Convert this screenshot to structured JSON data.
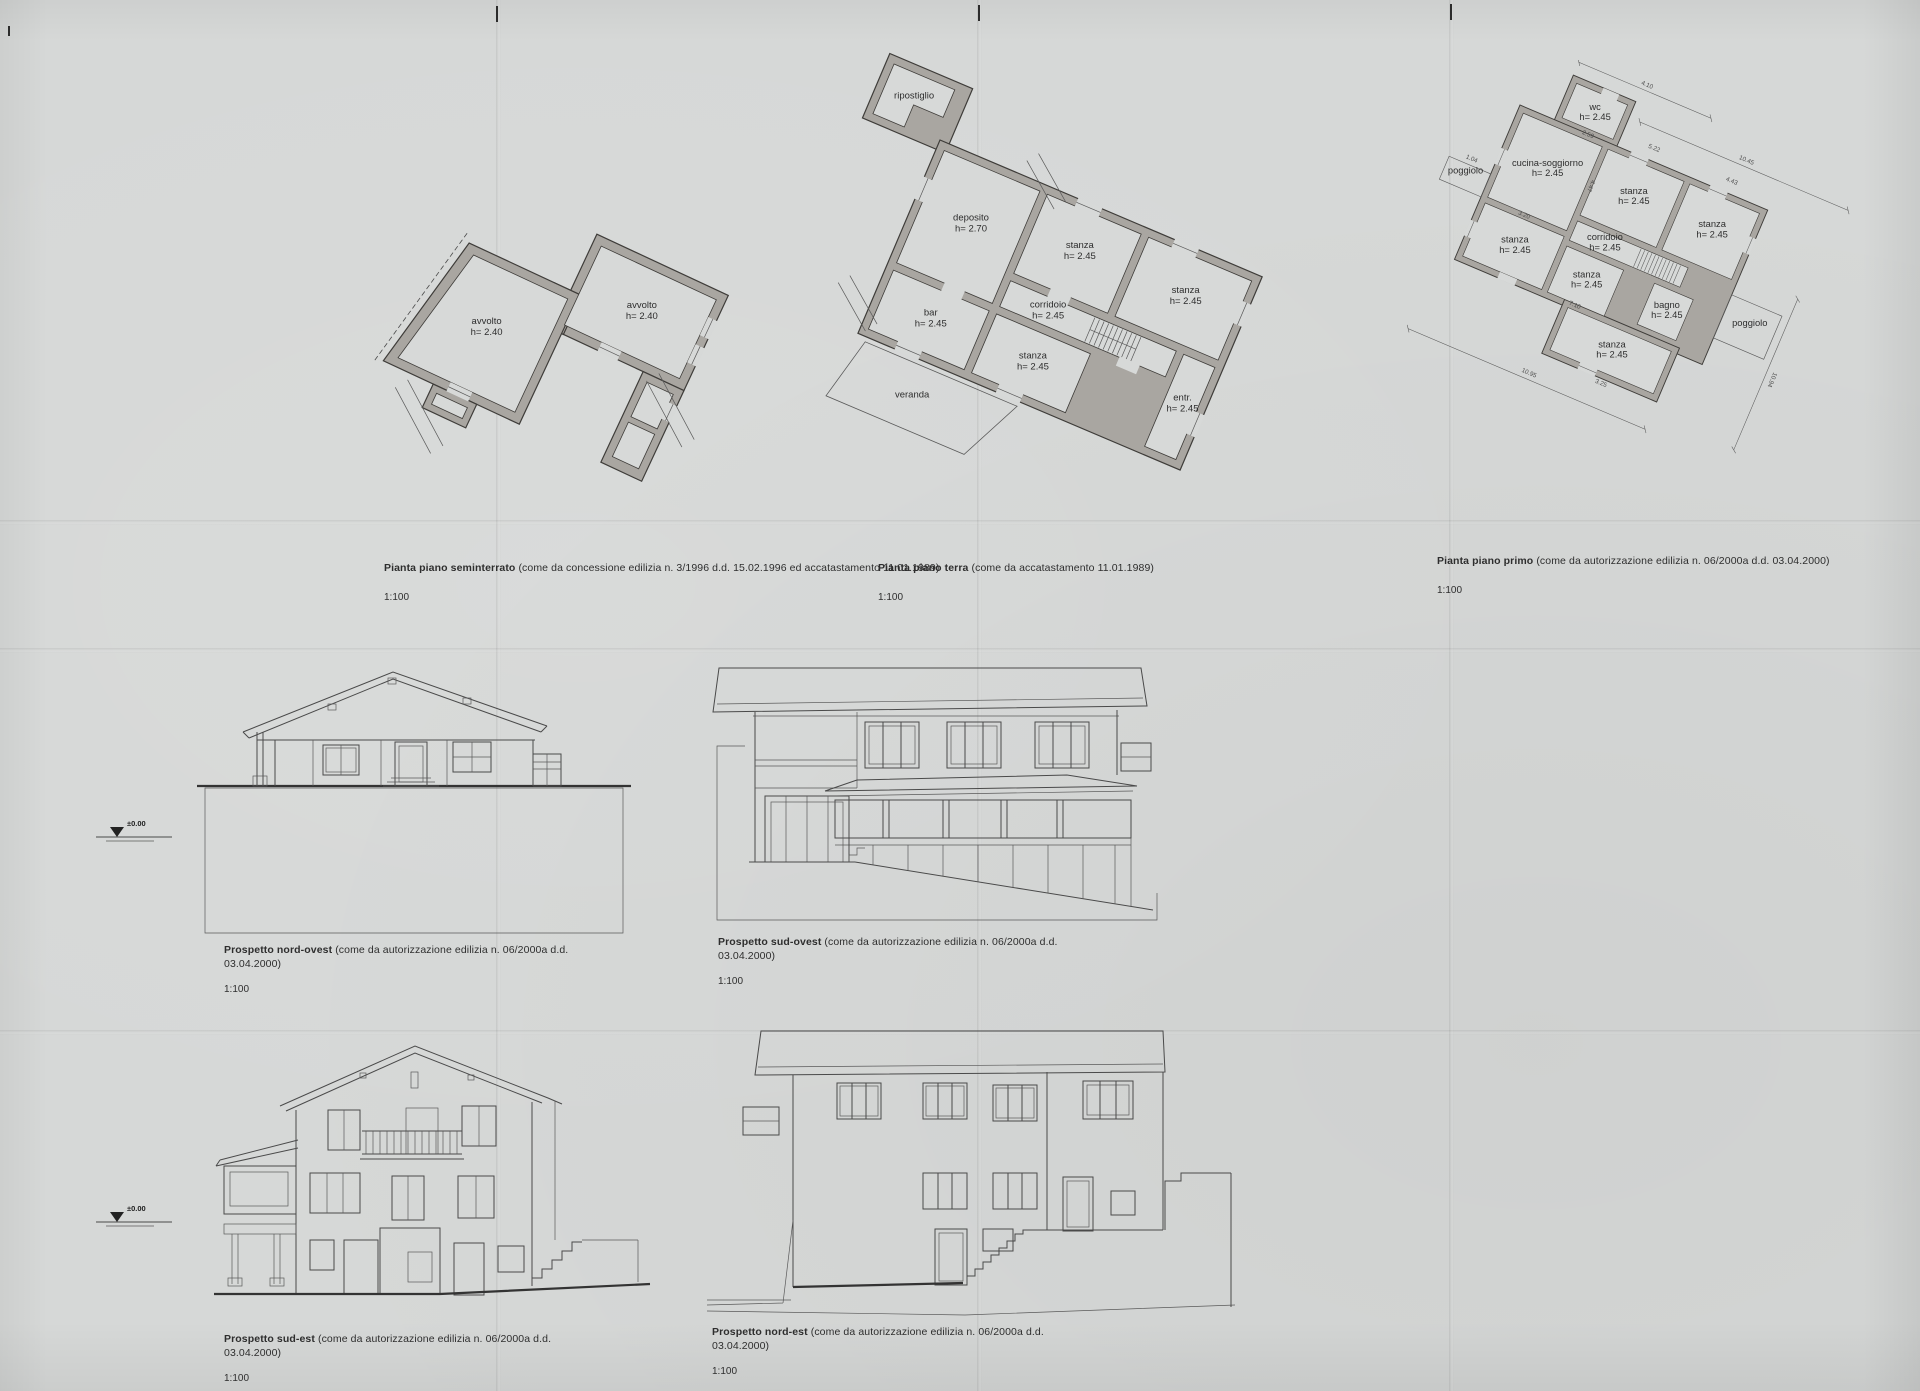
{
  "sheet": {
    "paper_color": "#d6d8d7",
    "wall_fill": "#a9a6a1",
    "line_color": "#4a4a4a"
  },
  "plans": [
    {
      "title": "Pianta piano seminterrato",
      "subtitle": "(come da concessione edilizia n. 3/1996 d.d. 15.02.1996 ed accatastamento 11.01.1989)",
      "scale": "1:100",
      "rooms": [
        {
          "label": "avvolto",
          "h": "h= 2.40"
        },
        {
          "label": "avvolto",
          "h": "h= 2.40"
        }
      ]
    },
    {
      "title": "Pianta piano terra",
      "subtitle": "(come da accatastamento 11.01.1989)",
      "scale": "1:100",
      "rooms": [
        {
          "label": "ripostiglio",
          "h": ""
        },
        {
          "label": "deposito",
          "h": "h= 2.70"
        },
        {
          "label": "stanza",
          "h": "h= 2.45"
        },
        {
          "label": "stanza",
          "h": "h= 2.45"
        },
        {
          "label": "corridoio",
          "h": "h= 2.45"
        },
        {
          "label": "bar",
          "h": "h= 2.45"
        },
        {
          "label": "stanza",
          "h": "h= 2.45"
        },
        {
          "label": "entr.",
          "h": "h= 2.45"
        },
        {
          "label": "veranda",
          "h": ""
        }
      ]
    },
    {
      "title": "Pianta piano primo",
      "subtitle": "(come da autorizzazione edilizia n. 06/2000a d.d. 03.04.2000)",
      "scale": "1:100",
      "rooms": [
        {
          "label": "wc",
          "h": "h= 2.45"
        },
        {
          "label": "cucina-soggiorno",
          "h": "h= 2.45"
        },
        {
          "label": "stanza",
          "h": "h= 2.45"
        },
        {
          "label": "stanza",
          "h": "h= 2.45"
        },
        {
          "label": "corridoio",
          "h": "h= 2.45"
        },
        {
          "label": "stanza",
          "h": "h= 2.45"
        },
        {
          "label": "stanza",
          "h": "h= 2.45"
        },
        {
          "label": "bagno",
          "h": "h= 2.45"
        },
        {
          "label": "stanza",
          "h": "h= 2.45"
        },
        {
          "label": "poggiolo",
          "h": ""
        },
        {
          "label": "poggiolo",
          "h": ""
        }
      ],
      "dims": {
        "top": "4.10",
        "ne": "10.45",
        "se": "10.94",
        "sw": "10.95",
        "inner": [
          "5.22",
          "4.43",
          "4.47",
          "3.20",
          "7.10",
          "3.25",
          "2.59",
          "1.04"
        ]
      }
    }
  ],
  "elevations": [
    {
      "title": "Prospetto nord-ovest",
      "subtitle": "(come da autorizzazione edilizia n. 06/2000a d.d. 03.04.2000)",
      "scale": "1:100",
      "level_marker": "±0.00"
    },
    {
      "title": "Prospetto sud-ovest",
      "subtitle": "(come da autorizzazione edilizia n. 06/2000a d.d. 03.04.2000)",
      "scale": "1:100"
    },
    {
      "title": "Prospetto sud-est",
      "subtitle": "(come da autorizzazione edilizia n. 06/2000a d.d. 03.04.2000)",
      "scale": "1:100",
      "level_marker": "±0.00"
    },
    {
      "title": "Prospetto nord-est",
      "subtitle": "(come da autorizzazione edilizia n. 06/2000a d.d. 03.04.2000)",
      "scale": "1:100"
    }
  ]
}
